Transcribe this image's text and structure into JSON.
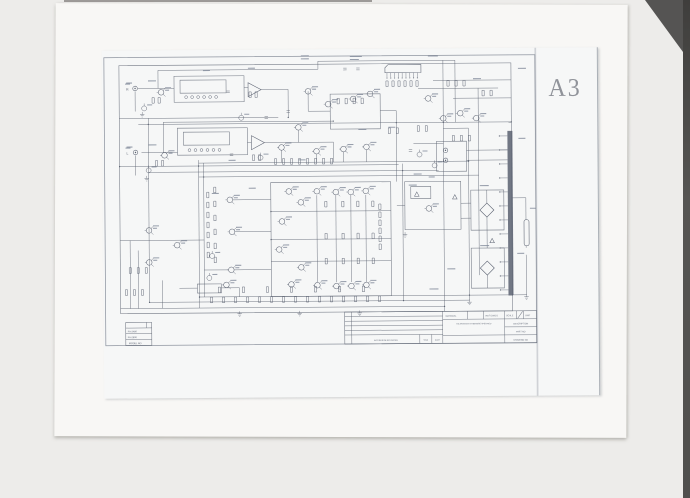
{
  "stamp": {
    "label": "A3"
  },
  "channels": {
    "right": "R",
    "left": "L"
  },
  "model_table": {
    "rows": [
      {
        "label": "FA-2480"
      },
      {
        "label": "FA-2600"
      },
      {
        "label": "MODEL NO"
      }
    ]
  },
  "title_block": {
    "material": "MATERIAL",
    "ref_dwgs": "REF DWG'S",
    "scale": "SCALE",
    "unit": "UNIT",
    "tolerance_note": "TOLERANCES OTHERWISE SPECIFIED",
    "description": "DESCRIPTION",
    "part_no": "PART NO",
    "drawing_no": "DRAWING NO",
    "revisions": "ALTERATION REVISIONS",
    "sign": "SIGN",
    "date": "DATE"
  },
  "colors": {
    "scanner_bg": "#edecea",
    "backing_paper": "#f8f7f5",
    "schematic_sheet": "#f6f7f7",
    "ink": "#5a6170",
    "stamp": "#7f828a",
    "edge_shadow": "#4e4d4b"
  }
}
